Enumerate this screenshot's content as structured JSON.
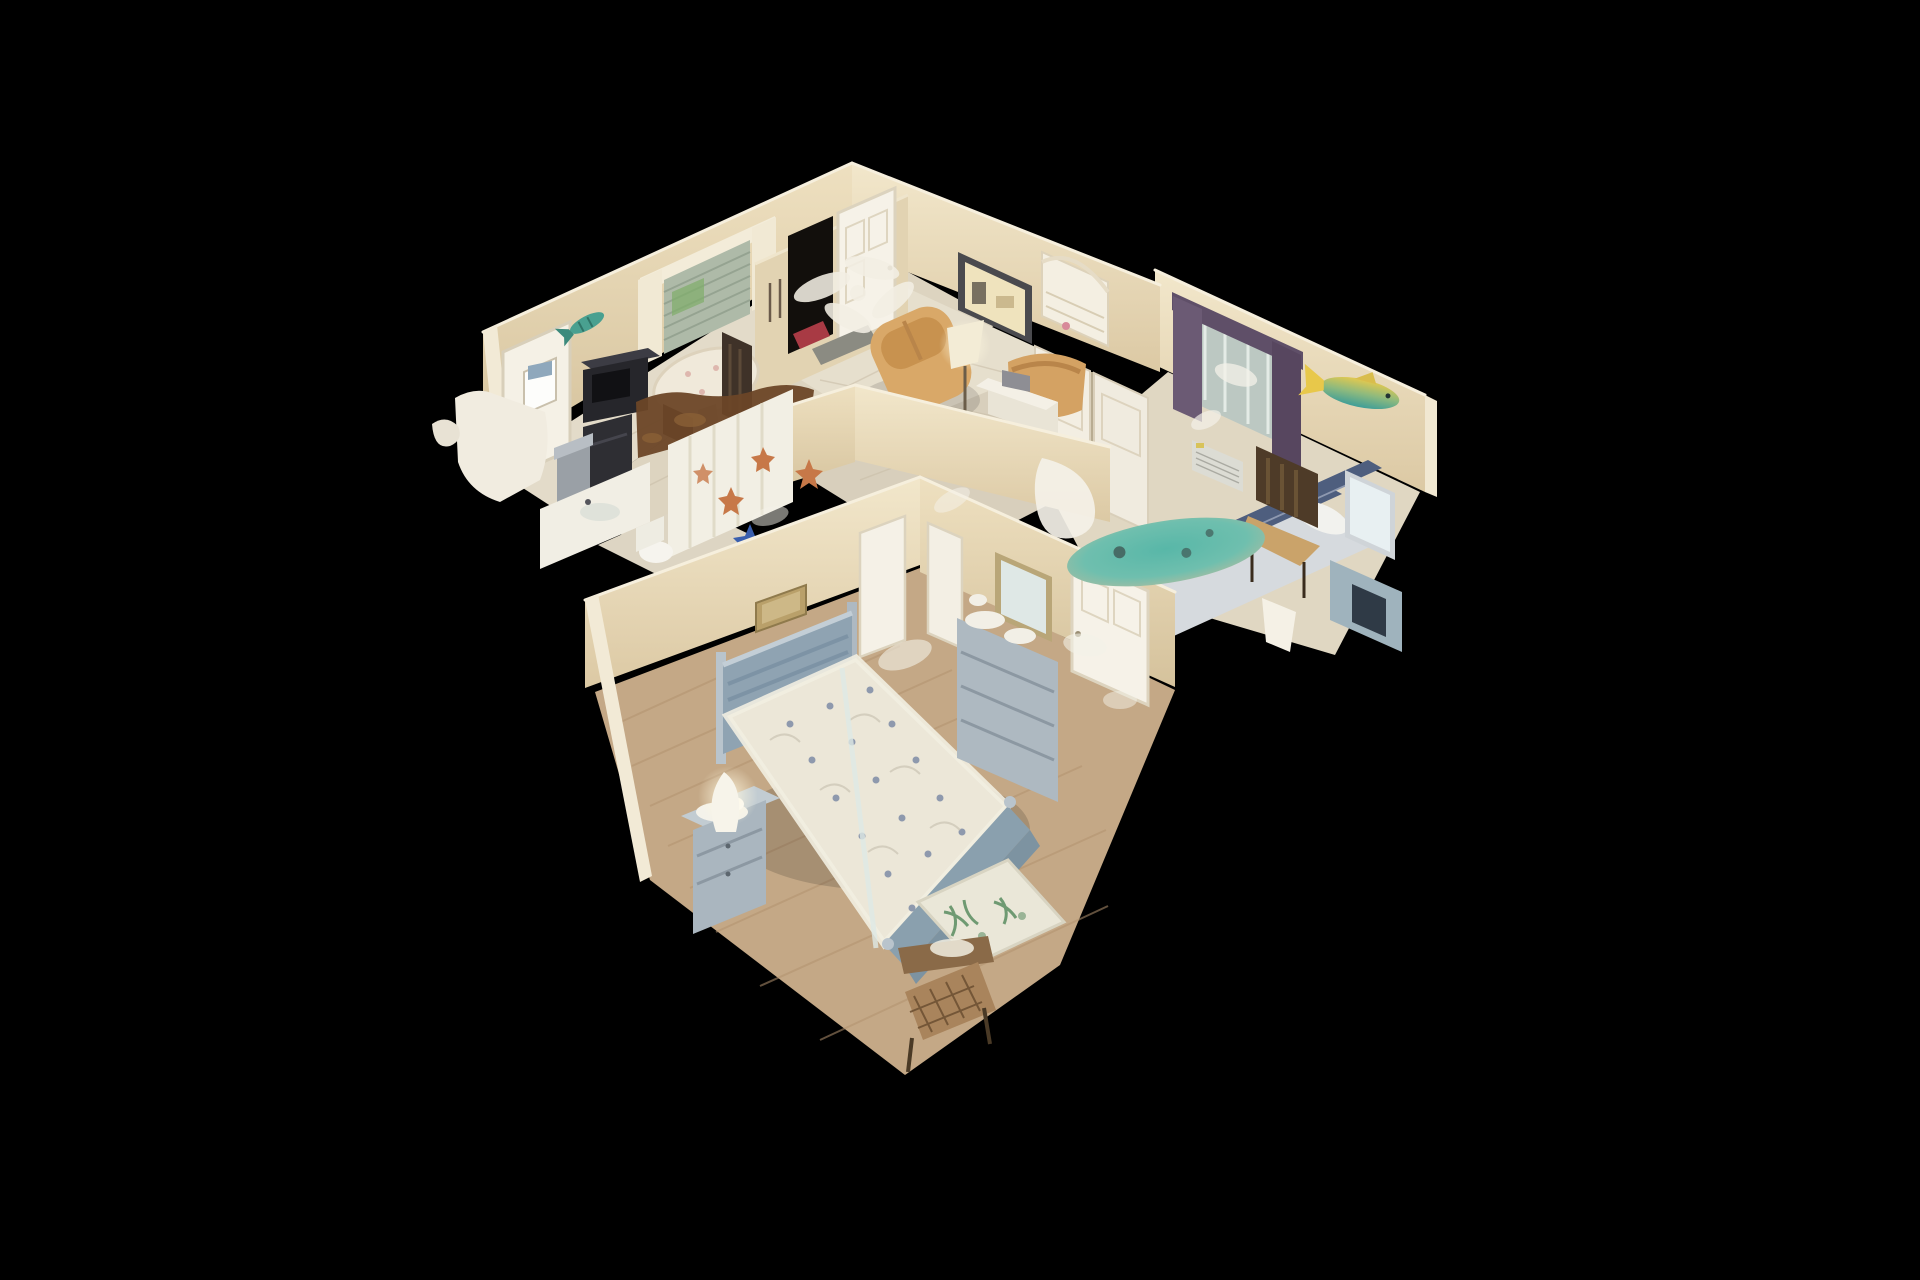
{
  "app": {
    "name": "3D dollhouse tour viewer",
    "background": "#000000"
  },
  "scene": {
    "view": "dollhouse-cutaway",
    "description": "Textured 3D scan of a small coastal-decor home viewed from above at an angle on a black void background",
    "rooms": [
      {
        "id": "kitchen-dining",
        "label": "Kitchen / Dining",
        "contents": [
          "round dining table with tablecloth",
          "dark wood dining chairs",
          "black microwave on cart",
          "stainless trash can",
          "white counters and fridge",
          "window with sheer curtains and blinds",
          "white exterior door with calendar",
          "teal fish wall decor",
          "brown scan-artifact counter"
        ]
      },
      {
        "id": "entry-living",
        "label": "Entry / Living Room",
        "contents": [
          "open front doorway",
          "white paneled front door",
          "ceiling fan scan artifact",
          "red entry mat",
          "gray floor mat",
          "two tan leather recliners",
          "floor lamp",
          "white side table",
          "dark framed mirror",
          "white hutch shelf",
          "tile floor",
          "pony half-wall"
        ]
      },
      {
        "id": "guest-bedroom",
        "label": "Guest Bedroom",
        "contents": [
          "window with purple curtains",
          "wall air conditioner",
          "navy striped bed with pillow",
          "teal surfboard scan artifact",
          "white closet double doors",
          "dark wood chair",
          "vanity mirror and dresser",
          "mounted yellow-teal fish",
          "white table lamp"
        ]
      },
      {
        "id": "bathroom",
        "label": "Bathroom",
        "contents": [
          "shower curtain with starfish pattern",
          "blue starfish",
          "orange starfish",
          "toilet",
          "vanity sink",
          "brown blobby scan artifacts"
        ]
      },
      {
        "id": "master-bedroom",
        "label": "Master Bedroom",
        "contents": [
          "blue-gray bed with floral quilt",
          "slatted headboard and posts",
          "footboard",
          "nightstand with doily and figurines",
          "white curvy lamp",
          "dresser vanity with gold framed mirror",
          "white interior doors",
          "green palm accent rug",
          "wicker chair",
          "bronze wall plaque",
          "wood plank floor"
        ]
      }
    ],
    "palette": {
      "background": "#000000",
      "wall": "#e9dcbf",
      "wall_shadow": "#d9c7a3",
      "wall_cut_edge": "#f6efdd",
      "tile_floor": "#e0d8c6",
      "wood_floor": "#c4a886",
      "recliner_tan": "#d9a868",
      "curtain_purple": "#5f4f68",
      "bed_stripe_navy": "#4e5e7e",
      "bed_frame_blue": "#8fa3b2",
      "surfboard_teal": "#58b7a8",
      "fish_yellow": "#e3c94f",
      "rug_green": "#6f9a72",
      "starfish_orange": "#c77848",
      "appliance_black": "#2b2b30",
      "entry_mat_red": "#a83a44"
    }
  }
}
